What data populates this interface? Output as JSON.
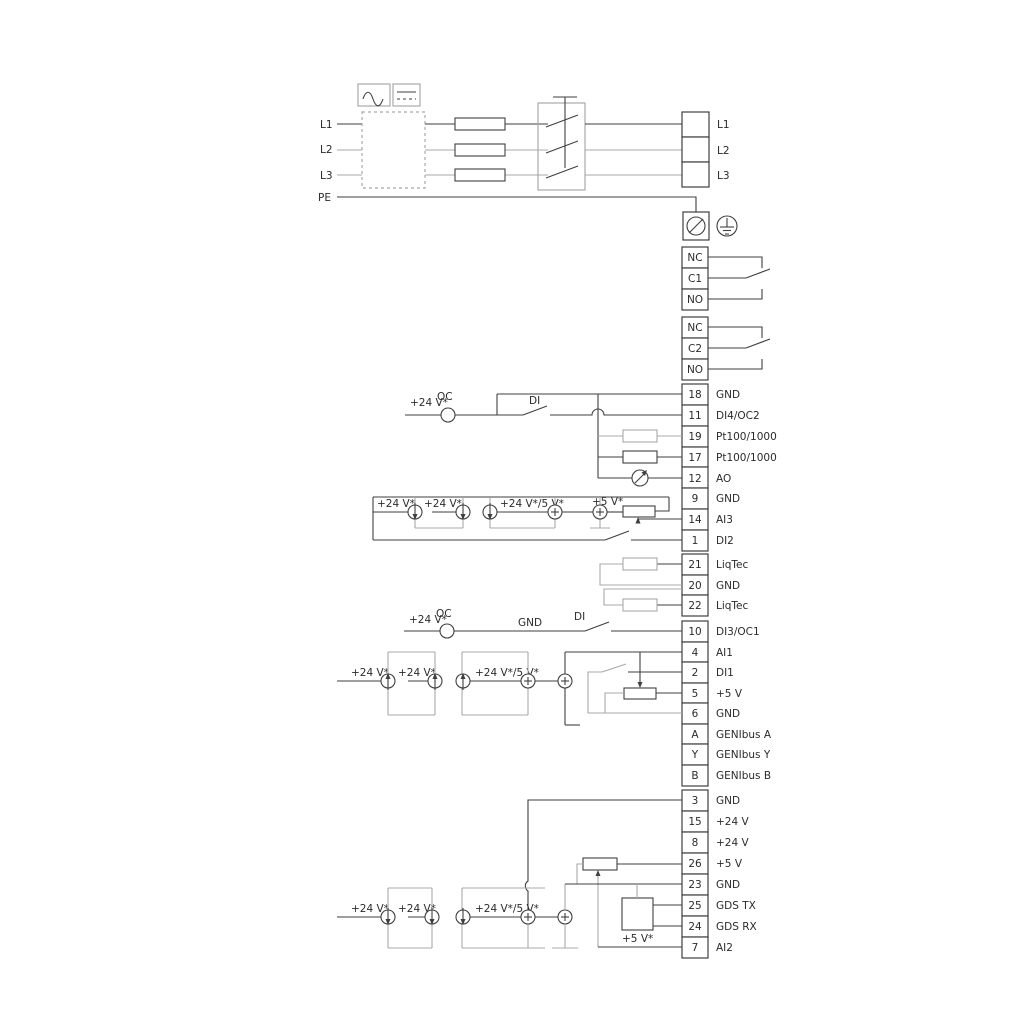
{
  "colors": {
    "wire_dark": "#3f3f3f",
    "wire_gray": "#a9a9a9",
    "text": "#2b2b2b",
    "background": "#ffffff"
  },
  "power_input": {
    "l1": "L1",
    "l2": "L2",
    "l3": "L3",
    "pe": "PE"
  },
  "power_output": {
    "l1": "L1",
    "l2": "L2",
    "l3": "L3"
  },
  "relays": {
    "relay1": {
      "nc": "NC",
      "com": "C1",
      "no": "NO"
    },
    "relay2": {
      "nc": "NC",
      "com": "C2",
      "no": "NO"
    }
  },
  "terminals": {
    "group1": [
      {
        "id": "18",
        "label": "GND"
      },
      {
        "id": "11",
        "label": "DI4/OC2"
      },
      {
        "id": "19",
        "label": "Pt100/1000"
      },
      {
        "id": "17",
        "label": "Pt100/1000"
      },
      {
        "id": "12",
        "label": "AO"
      },
      {
        "id": "9",
        "label": "GND"
      },
      {
        "id": "14",
        "label": "AI3"
      },
      {
        "id": "1",
        "label": "DI2"
      }
    ],
    "liqtec": [
      {
        "id": "21",
        "label": "LiqTec"
      },
      {
        "id": "20",
        "label": "GND"
      },
      {
        "id": "22",
        "label": "LiqTec"
      }
    ],
    "group2": [
      {
        "id": "10",
        "label": "DI3/OC1"
      },
      {
        "id": "4",
        "label": "AI1"
      },
      {
        "id": "2",
        "label": "DI1"
      },
      {
        "id": "5",
        "label": "+5 V"
      },
      {
        "id": "6",
        "label": "GND"
      },
      {
        "id": "A",
        "label": "GENIbus A"
      },
      {
        "id": "Y",
        "label": "GENIbus Y"
      },
      {
        "id": "B",
        "label": "GENIbus B"
      }
    ],
    "group3": [
      {
        "id": "3",
        "label": "GND"
      },
      {
        "id": "15",
        "label": "+24 V"
      },
      {
        "id": "8",
        "label": "+24 V"
      },
      {
        "id": "26",
        "label": "+5 V"
      },
      {
        "id": "23",
        "label": "GND"
      },
      {
        "id": "25",
        "label": "GDS TX"
      },
      {
        "id": "24",
        "label": "GDS RX"
      },
      {
        "id": "7",
        "label": "AI2"
      }
    ]
  },
  "annotations": {
    "v24": "+24 V*",
    "v24_5": "+24 V*/5 V*",
    "v5": "+5 V*",
    "oc": "OC",
    "di": "DI",
    "gnd": "GND"
  }
}
